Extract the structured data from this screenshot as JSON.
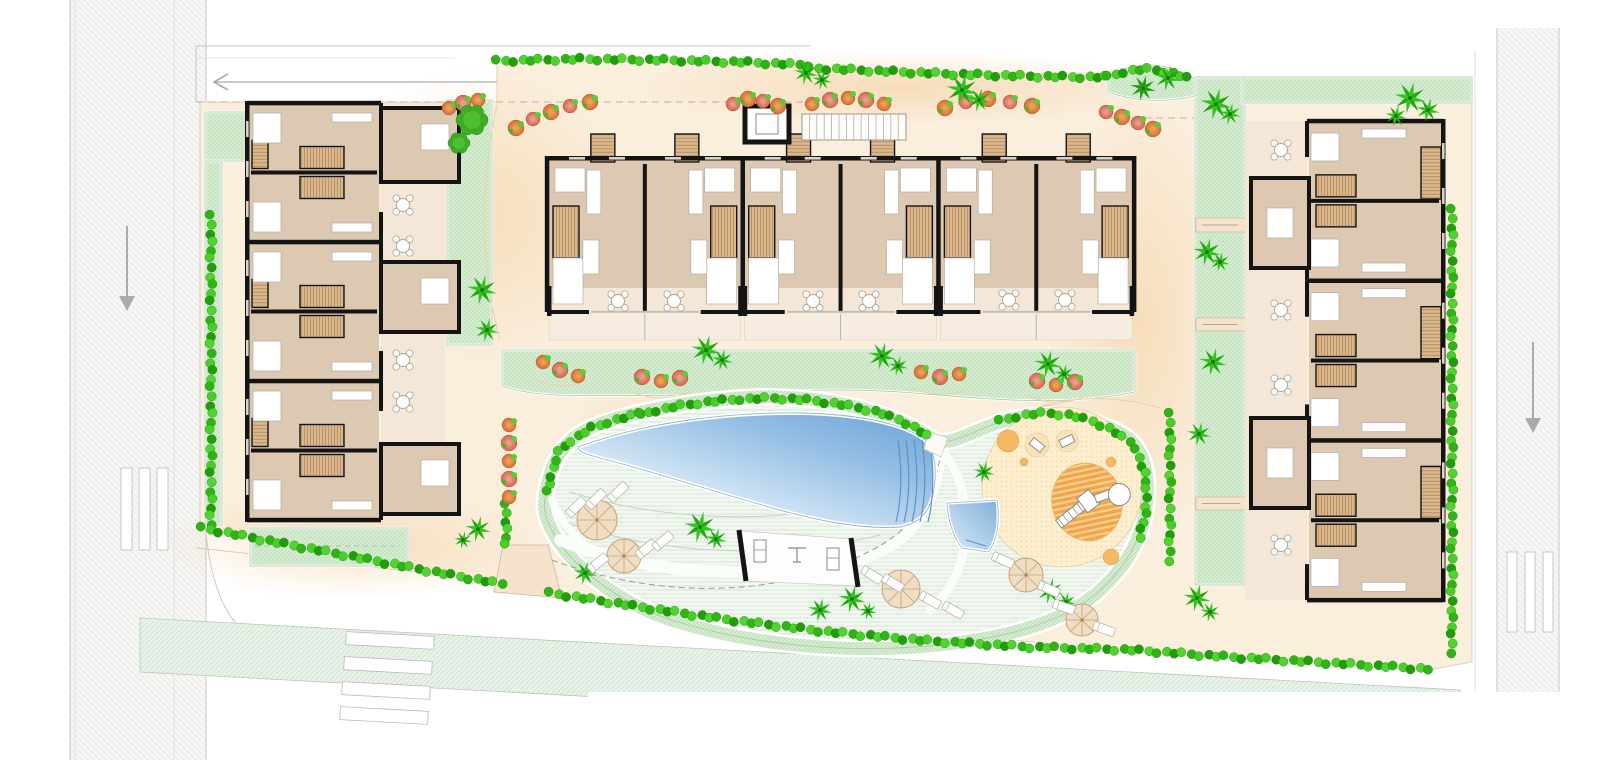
{
  "meta": {
    "type": "architectural-site-plan",
    "width": 1620,
    "height": 760
  },
  "palette": {
    "paper": "#ffffff",
    "road": "#f6f6f4",
    "road_line": "#c9c6c2",
    "road_line_soft": "#dedbd7",
    "strip_green": "#eaf3ea",
    "strip_line": "#b9c9b4",
    "parcel": "#faeedd",
    "peach": "#f5cf9e",
    "paving_edge": "#cfc8bd",
    "lawn": "#d5ecd1",
    "lawn_line": "#bedfb9",
    "lawn_rim": "#a9c4a5",
    "deck": "#f3f7f2",
    "deck_line": "#d6e5d4",
    "pad": "#fdeecd",
    "pad_dot": "#f2d6a4",
    "pool_light": "#f2f8fc",
    "pool_dark": "#6ba3d6",
    "pool_edge": "#93b3cc",
    "pool_step": "#5d93c4",
    "wall": "#141414",
    "floor": "#ddc8b2",
    "terrace": "#f4e7d8",
    "terrace_ext": "#f6ecdf",
    "wood": "#dab88e",
    "wood_line": "#bd9166",
    "furniture": "#ffffff",
    "furniture_line": "#b4ada1",
    "hedge": [
      "#2eb513",
      "#47cf27",
      "#1f9e0a",
      "#52d430"
    ],
    "palm": [
      "#2ec41c",
      "#1fa80e"
    ],
    "bush_orange": [
      "#efa058",
      "#cf6d36"
    ],
    "bush_pink": [
      "#ec9b8a",
      "#d2654f"
    ],
    "bush_leaf": "#57ce36",
    "playground_orange": "#f1a64a",
    "playground_stripe": "#f9d094",
    "playground_dot": "#f5b963",
    "arrow": "#ababab",
    "dash": "#b9b3a8",
    "contour": "#edd0a8"
  },
  "roads": {
    "left": {
      "x": 70,
      "w": 136,
      "arrow": {
        "x": 127,
        "y1": 226,
        "y2": 298,
        "dir": "down"
      },
      "bars": [
        [
          121,
          468,
          11,
          82
        ],
        [
          139,
          468,
          11,
          82
        ],
        [
          157,
          468,
          11,
          82
        ]
      ]
    },
    "right": {
      "x": 1497,
      "w": 62,
      "y": 28,
      "arrow": {
        "x": 1533,
        "y1": 342,
        "y2": 420,
        "dir": "down"
      },
      "bars": [
        [
          1507,
          552,
          10,
          80
        ],
        [
          1525,
          552,
          10,
          80
        ],
        [
          1543,
          552,
          10,
          80
        ]
      ]
    },
    "top_walk": {
      "x1": 196,
      "x2": 810,
      "y1": 46,
      "y2": 102,
      "arrow_y": 82,
      "arrow_x1": 214,
      "arrow_x2": 520
    },
    "bottom_strip": {
      "pts": [
        [
          140,
          618
        ],
        [
          1460,
          690
        ],
        [
          1460,
          744
        ],
        [
          140,
          672
        ]
      ],
      "bars": [
        [
          346,
          634,
          88,
          13
        ],
        [
          344,
          659,
          88,
          13
        ],
        [
          342,
          684,
          88,
          13
        ],
        [
          340,
          709,
          88,
          13
        ]
      ]
    },
    "sidewalk_edge": [
      [
        197,
        548
      ],
      [
        1135,
        650
      ],
      [
        1432,
        670
      ]
    ]
  },
  "parcel": {
    "pts": [
      [
        200,
        102
      ],
      [
        497,
        102
      ],
      [
        497,
        60
      ],
      [
        810,
        64
      ],
      [
        810,
        68
      ],
      [
        1108,
        76
      ],
      [
        1195,
        77
      ],
      [
        1472,
        77
      ],
      [
        1472,
        662
      ],
      [
        1428,
        670
      ],
      [
        1135,
        652
      ],
      [
        548,
        594
      ],
      [
        502,
        585
      ],
      [
        200,
        528
      ]
    ],
    "peach_spots": [
      [
        480,
        215,
        150,
        150
      ],
      [
        1140,
        320,
        95,
        225
      ],
      [
        900,
        88,
        270,
        38
      ],
      [
        350,
        545,
        190,
        55
      ],
      [
        630,
        470,
        70,
        90
      ]
    ],
    "dashes": [
      [
        [
          196,
          102
        ],
        [
          810,
          102
        ]
      ],
      [
        [
          1108,
          118
        ],
        [
          1245,
          118
        ]
      ]
    ]
  },
  "lawns": [
    {
      "name": "lawn-topleft",
      "rect": [
        205,
        112,
        42,
        49
      ]
    },
    {
      "name": "lawn-left-strip",
      "rect": [
        205,
        161,
        17,
        364
      ]
    },
    {
      "name": "lawn-left-garden",
      "rect": [
        447,
        100,
        45,
        245
      ]
    },
    {
      "name": "lawn-below-left-building",
      "rect": [
        250,
        528,
        158,
        38
      ]
    },
    {
      "name": "lawn-center-band",
      "path": "M502,350 L1135,350 L1135,392 C1060,408 980,398 900,392 C800,385 740,398 680,396 C600,394 540,400 502,386 Z"
    },
    {
      "name": "lawn-right-strip",
      "rect": [
        1195,
        77,
        50,
        508
      ]
    },
    {
      "name": "lawn-topright",
      "rect": [
        1242,
        77,
        230,
        26
      ]
    },
    {
      "name": "lawn-blob",
      "path": "M1108,77 C1122,66 1150,62 1170,68 C1182,72 1190,77 1195,79 L1195,96 C1160,104 1130,100 1108,92 Z"
    }
  ],
  "lawn_walk_gaps": [
    [
      1196,
      218,
      50,
      14
    ],
    [
      1196,
      318,
      50,
      13
    ],
    [
      1196,
      497,
      52,
      13
    ]
  ],
  "amenity": {
    "boundary": "M545,498 C550,460 565,436 600,424 C640,410 700,399 760,397 C820,396 880,406 933,439 C948,448 970,432 1000,422 C1040,410 1090,416 1122,434 C1142,446 1149,468 1147,498 C1145,534 1128,566 1096,594 C1056,626 996,640 928,646 C848,653 758,646 678,622 C618,604 572,566 554,534 C546,520 543,510 545,498 Z",
    "walkways": [
      {
        "d": "M560,540 C650,576 760,582 870,556",
        "w": 12
      },
      {
        "d": "M870,556 C915,540 935,505 941,455",
        "w": 10
      },
      {
        "d": "M942,452 C960,470 968,500 965,540 C962,570 950,592 930,610",
        "w": 9
      },
      {
        "d": "M552,500 C560,520 570,532 585,545",
        "w": 8
      }
    ],
    "deck_arcs": [
      "M560,520 C660,556 780,560 880,535",
      "M570,492 C660,520 760,524 860,505"
    ],
    "center_dash": "M552,560 C660,600 780,598 868,552 C908,533 932,502 940,458",
    "pool": "M578,447 C640,424 720,412 800,413 C860,414 906,424 926,441 C936,452 937,474 933,495 C929,513 918,524 900,527 C858,530 810,519 762,505 C706,489 640,468 600,458 C586,454 578,452 578,447 Z",
    "pool_steps_x": [
      898,
      906,
      914,
      922,
      930
    ],
    "small_pool": "M947,503 L997,500 C1000,520 998,540 988,552 L962,548 C952,535 948,520 947,503 Z",
    "gym": {
      "floor": [
        [
          741,
          531
        ],
        [
          852,
          539
        ],
        [
          858,
          586
        ],
        [
          746,
          581
        ]
      ],
      "bars": [
        [
          739,
          530,
          746,
          581
        ],
        [
          851,
          538,
          858,
          587
        ]
      ]
    },
    "entrance_south": [
      [
        503,
        545
      ],
      [
        548,
        545
      ],
      [
        562,
        598
      ],
      [
        494,
        592
      ]
    ],
    "entrance_north": [
      [
        928,
        431
      ],
      [
        948,
        438
      ],
      [
        941,
        457
      ],
      [
        924,
        449
      ]
    ]
  },
  "playground": {
    "pad": [
      1062,
      487,
      80
    ],
    "ellipse": [
      1087,
      502,
      35,
      39,
      -12
    ],
    "dots": [
      [
        1008,
        441,
        11,
        "solid"
      ],
      [
        1111,
        462,
        5,
        "solid"
      ],
      [
        1111,
        557,
        8,
        "solid"
      ],
      [
        1024,
        462,
        4,
        "solid"
      ]
    ],
    "pale_circles": [
      [
        1037,
        445,
        12
      ],
      [
        1067,
        441,
        11
      ]
    ],
    "toys": [
      [
        1037,
        445,
        38
      ],
      [
        1067,
        441,
        -25
      ]
    ]
  },
  "buildings": {
    "center": {
      "x0": 547,
      "pair_w": 195.7,
      "pairs": 3,
      "y_prot": 134,
      "y_top": 158,
      "y_glass": 288,
      "y_bottom": 310,
      "y_ext": 340
    },
    "left": {
      "x1": 247,
      "x2": 381,
      "y0": 103,
      "pair_h": 139,
      "pairs": 3,
      "patio": [
        381,
        103,
        64,
        417
      ],
      "protrusions": [
        [
          381,
          108,
          78,
          74
        ],
        [
          381,
          262,
          78,
          70
        ],
        [
          381,
          444,
          78,
          70
        ]
      ]
    },
    "right": {
      "x1": 1307,
      "x2": 1443,
      "y0": 121,
      "pair_h": 159.7,
      "pairs": 3,
      "patio": [
        1245,
        121,
        62,
        479
      ],
      "protrusions": [
        [
          1251,
          178,
          58,
          90
        ],
        [
          1251,
          418,
          58,
          90
        ]
      ]
    }
  },
  "structures": {
    "elevator": [
      745,
      106,
      44,
      36
    ],
    "pergola": [
      802,
      114,
      104,
      26
    ]
  },
  "hedges": [
    {
      "name": "hedge-top-1",
      "pts": [
        [
          497,
          61
        ],
        [
          580,
          59
        ],
        [
          660,
          60
        ],
        [
          740,
          62
        ],
        [
          808,
          65
        ]
      ]
    },
    {
      "name": "hedge-top-2",
      "pts": [
        [
          810,
          68
        ],
        [
          880,
          71
        ],
        [
          950,
          74
        ],
        [
          1020,
          76
        ],
        [
          1070,
          77
        ],
        [
          1106,
          77
        ]
      ]
    },
    {
      "name": "hedge-blob",
      "pts": [
        [
          1108,
          77
        ],
        [
          1126,
          71
        ],
        [
          1146,
          69
        ],
        [
          1168,
          72
        ],
        [
          1188,
          78
        ]
      ]
    },
    {
      "name": "hedge-west",
      "pts": [
        [
          211,
          216
        ],
        [
          211,
          525
        ]
      ]
    },
    {
      "name": "hedge-southwest",
      "pts": [
        [
          202,
          528
        ],
        [
          280,
          543
        ],
        [
          360,
          558
        ],
        [
          440,
          573
        ],
        [
          502,
          584
        ]
      ]
    },
    {
      "name": "hedge-south",
      "pts": [
        [
          550,
          593
        ],
        [
          640,
          607
        ],
        [
          730,
          620
        ],
        [
          830,
          632
        ],
        [
          930,
          641
        ],
        [
          1030,
          647
        ],
        [
          1132,
          650
        ],
        [
          1230,
          657
        ],
        [
          1330,
          663
        ],
        [
          1428,
          669
        ]
      ]
    },
    {
      "name": "hedge-east",
      "pts": [
        [
          1452,
          210
        ],
        [
          1452,
          652
        ]
      ]
    },
    {
      "name": "hedge-pool-west",
      "pts": [
        [
          548,
          492
        ],
        [
          552,
          470
        ],
        [
          560,
          450
        ],
        [
          574,
          438
        ],
        [
          592,
          428
        ],
        [
          614,
          420
        ],
        [
          640,
          414
        ]
      ]
    },
    {
      "name": "hedge-pool-north",
      "pts": [
        [
          640,
          414
        ],
        [
          672,
          407
        ],
        [
          706,
          402
        ],
        [
          740,
          399
        ],
        [
          775,
          398
        ],
        [
          810,
          400
        ],
        [
          845,
          405
        ],
        [
          878,
          412
        ],
        [
          905,
          422
        ],
        [
          928,
          436
        ]
      ]
    },
    {
      "name": "hedge-playground-north",
      "pts": [
        [
          1000,
          421
        ],
        [
          1022,
          415
        ],
        [
          1046,
          413
        ],
        [
          1070,
          415
        ],
        [
          1092,
          421
        ],
        [
          1112,
          430
        ],
        [
          1130,
          442
        ]
      ]
    },
    {
      "name": "hedge-playground-east",
      "pts": [
        [
          1136,
          450
        ],
        [
          1144,
          470
        ],
        [
          1147,
          492
        ],
        [
          1145,
          515
        ],
        [
          1140,
          538
        ]
      ]
    },
    {
      "name": "hedge-entrance",
      "pts": [
        [
          506,
          505
        ],
        [
          506,
          545
        ]
      ]
    },
    {
      "name": "hedge-right-strip",
      "pts": [
        [
          1170,
          414
        ],
        [
          1170,
          560
        ]
      ]
    }
  ],
  "bushes": [
    [
      449,
      108,
      0
    ],
    [
      463,
      103,
      1
    ],
    [
      478,
      100,
      0
    ],
    [
      516,
      128,
      0
    ],
    [
      533,
      119,
      1
    ],
    [
      551,
      112,
      0
    ],
    [
      570,
      106,
      1
    ],
    [
      590,
      102,
      0
    ],
    [
      733,
      104,
      1
    ],
    [
      748,
      99,
      0
    ],
    [
      763,
      101,
      1
    ],
    [
      778,
      106,
      0
    ],
    [
      812,
      104,
      0
    ],
    [
      830,
      100,
      1
    ],
    [
      848,
      98,
      0
    ],
    [
      866,
      100,
      1
    ],
    [
      884,
      104,
      0
    ],
    [
      945,
      108,
      0
    ],
    [
      966,
      102,
      1
    ],
    [
      988,
      99,
      0
    ],
    [
      1010,
      102,
      1
    ],
    [
      1032,
      106,
      0
    ],
    [
      1106,
      112,
      1
    ],
    [
      1122,
      117,
      0
    ],
    [
      1138,
      123,
      1
    ],
    [
      1153,
      129,
      0
    ],
    [
      543,
      362,
      0
    ],
    [
      560,
      370,
      1
    ],
    [
      578,
      376,
      0
    ],
    [
      642,
      377,
      1
    ],
    [
      661,
      381,
      0
    ],
    [
      680,
      378,
      1
    ],
    [
      921,
      372,
      0
    ],
    [
      940,
      377,
      1
    ],
    [
      959,
      374,
      0
    ],
    [
      1037,
      381,
      1
    ],
    [
      1056,
      385,
      0
    ],
    [
      1075,
      382,
      1
    ],
    [
      509,
      425,
      0
    ],
    [
      509,
      443,
      1
    ],
    [
      509,
      461,
      0
    ],
    [
      509,
      479,
      1
    ],
    [
      509,
      497,
      0
    ]
  ],
  "trees": [
    [
      472,
      120,
      16
    ],
    [
      459,
      143,
      11
    ]
  ],
  "star_tree": [
    1143,
    88,
    13
  ],
  "palms": [
    [
      482,
      290,
      15
    ],
    [
      487,
      330,
      12
    ],
    [
      806,
      73,
      12
    ],
    [
      822,
      80,
      10
    ],
    [
      962,
      90,
      16
    ],
    [
      979,
      100,
      12
    ],
    [
      1168,
      78,
      13
    ],
    [
      1216,
      104,
      16
    ],
    [
      1230,
      114,
      11
    ],
    [
      1207,
      252,
      14
    ],
    [
      1220,
      262,
      10
    ],
    [
      1213,
      362,
      14
    ],
    [
      1199,
      434,
      12
    ],
    [
      1197,
      598,
      14
    ],
    [
      1210,
      612,
      10
    ],
    [
      1410,
      98,
      16
    ],
    [
      1428,
      110,
      12
    ],
    [
      1396,
      116,
      11
    ],
    [
      706,
      350,
      15
    ],
    [
      722,
      360,
      11
    ],
    [
      882,
      356,
      14
    ],
    [
      898,
      366,
      10
    ],
    [
      1048,
      364,
      14
    ],
    [
      1064,
      374,
      10
    ],
    [
      700,
      527,
      16
    ],
    [
      716,
      539,
      11
    ],
    [
      585,
      573,
      12
    ],
    [
      820,
      610,
      12
    ],
    [
      852,
      599,
      14
    ],
    [
      868,
      611,
      9
    ],
    [
      1050,
      591,
      13
    ],
    [
      1066,
      602,
      10
    ],
    [
      984,
      472,
      11
    ],
    [
      478,
      529,
      13
    ],
    [
      463,
      540,
      9
    ]
  ],
  "loungers": [
    [
      576,
      507,
      -44
    ],
    [
      596,
      499,
      -44
    ],
    [
      618,
      492,
      -44
    ],
    [
      598,
      563,
      -40
    ],
    [
      646,
      549,
      -40
    ],
    [
      663,
      541,
      -40
    ],
    [
      872,
      575,
      32
    ],
    [
      893,
      583,
      32
    ],
    [
      930,
      600,
      30
    ],
    [
      953,
      610,
      30
    ],
    [
      1003,
      560,
      24
    ],
    [
      1049,
      589,
      24
    ],
    [
      1064,
      607,
      20
    ],
    [
      1104,
      629,
      20
    ]
  ],
  "parasols": [
    [
      597,
      520,
      20
    ],
    [
      624,
      556,
      17
    ],
    [
      901,
      589,
      19
    ],
    [
      1026,
      575,
      17
    ],
    [
      1082,
      620,
      16
    ]
  ],
  "tables": [
    [
      403,
      205
    ],
    [
      403,
      246
    ],
    [
      403,
      360
    ],
    [
      403,
      402
    ],
    [
      618,
      301
    ],
    [
      674,
      301
    ],
    [
      813,
      301
    ],
    [
      869,
      301
    ],
    [
      1009,
      300
    ],
    [
      1065,
      300
    ],
    [
      1281,
      150
    ],
    [
      1281,
      310
    ],
    [
      1281,
      385
    ],
    [
      1281,
      545
    ]
  ],
  "contours": [
    "M995,432 C1030,398 1100,390 1160,408",
    "M960,448 C990,420 1020,408 1060,404",
    "M497,105 C480,180 480,270 500,340",
    "M430,108 C446,180 446,260 432,332",
    "M532,378 Q560,392 588,380",
    "M632,392 Q661,404 690,392",
    "M912,388 Q940,400 968,389",
    "M1028,396 Q1056,408 1084,397"
  ],
  "covers": [
    [
      588,
      692,
      1032,
      68
    ],
    [
      1575,
      0,
      45,
      760
    ]
  ]
}
